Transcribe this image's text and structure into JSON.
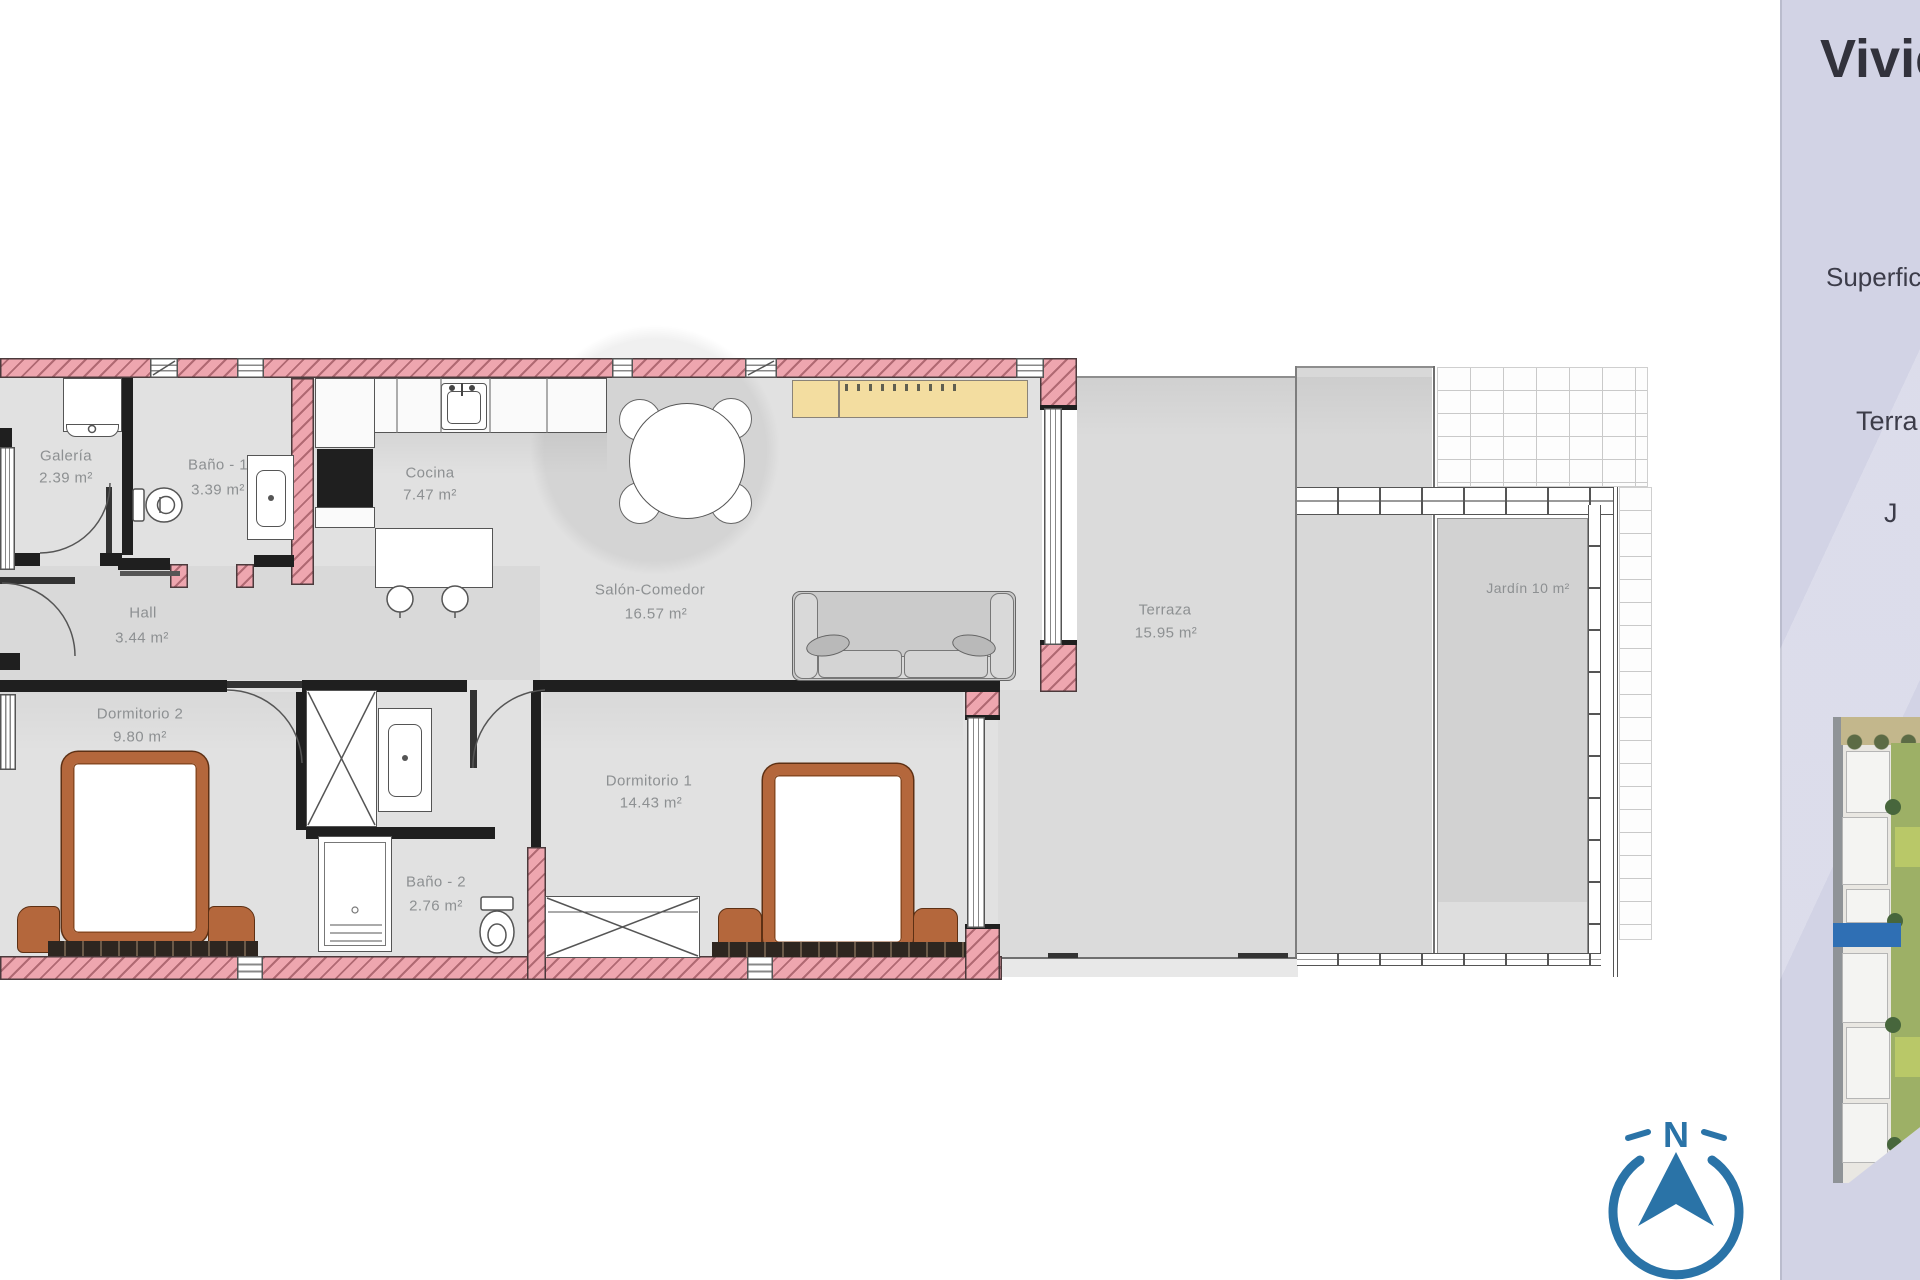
{
  "plan": {
    "rooms": {
      "galeria": {
        "name": "Galería",
        "area": "2.39 m²"
      },
      "bano1": {
        "name": "Baño - 1",
        "area": "3.39 m²"
      },
      "cocina": {
        "name": "Cocina",
        "area": "7.47 m²"
      },
      "salon": {
        "name": "Salón-Comedor",
        "area": "16.57 m²"
      },
      "hall": {
        "name": "Hall",
        "area": "3.44 m²"
      },
      "dormitorio2": {
        "name": "Dormitorio 2",
        "area": "9.80 m²"
      },
      "bano2": {
        "name": "Baño - 2",
        "area": "2.76 m²"
      },
      "dormitorio1": {
        "name": "Dormitorio 1",
        "area": "14.43 m²"
      },
      "terraza": {
        "name": "Terraza",
        "area": "15.95 m²"
      },
      "jardin": {
        "label": "Jardín 10 m²"
      }
    }
  },
  "panel": {
    "title": "Vivie",
    "line_superficie": "Superfic",
    "line_terraza": "Terra",
    "line_jardin": "J"
  },
  "compass": {
    "label": "N"
  },
  "colors": {
    "wall_pink": "#eea6af",
    "accent_blue": "#2a73a7",
    "sideboard_yellow": "#f3dda0",
    "bed_brown": "#b4673c",
    "sidebar_bg": "#d2d3e5"
  }
}
